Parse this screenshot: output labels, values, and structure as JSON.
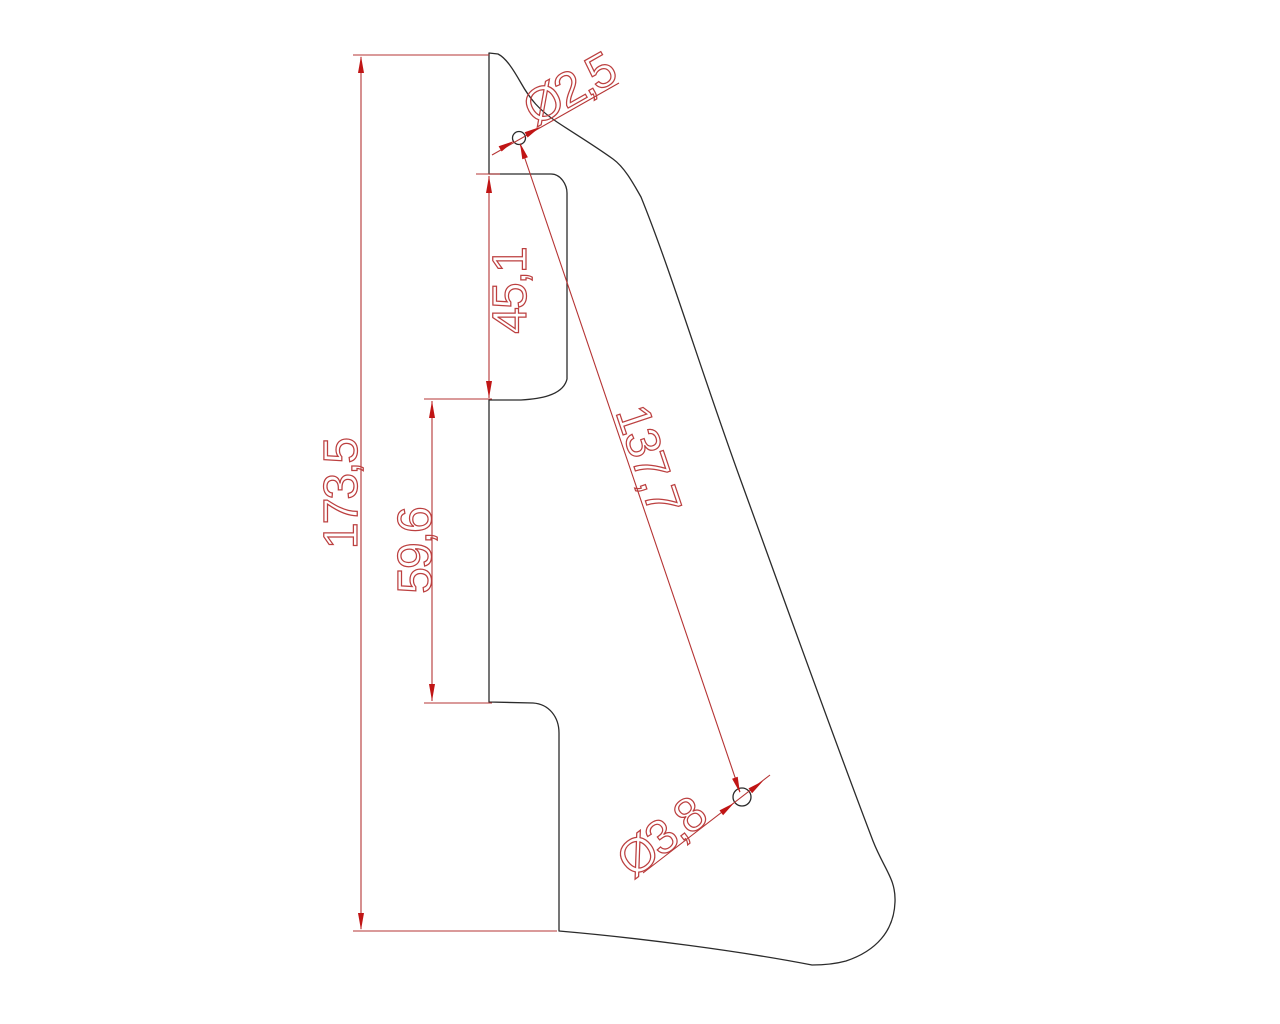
{
  "drawing": {
    "kind": "cad-technical-drawing",
    "part": "pickguard-outline-with-dimensions",
    "colors": {
      "background": "#ffffff",
      "outline": "#2b2b2b",
      "dimension": "#c01515"
    },
    "labels": {
      "overall_height": "173,5",
      "notch_height": "45,1",
      "mid_edge_height": "59,6",
      "hole_distance": "137,7",
      "upper_hole_diameter": "Ø2,5",
      "lower_hole_diameter": "Ø3,8"
    }
  }
}
